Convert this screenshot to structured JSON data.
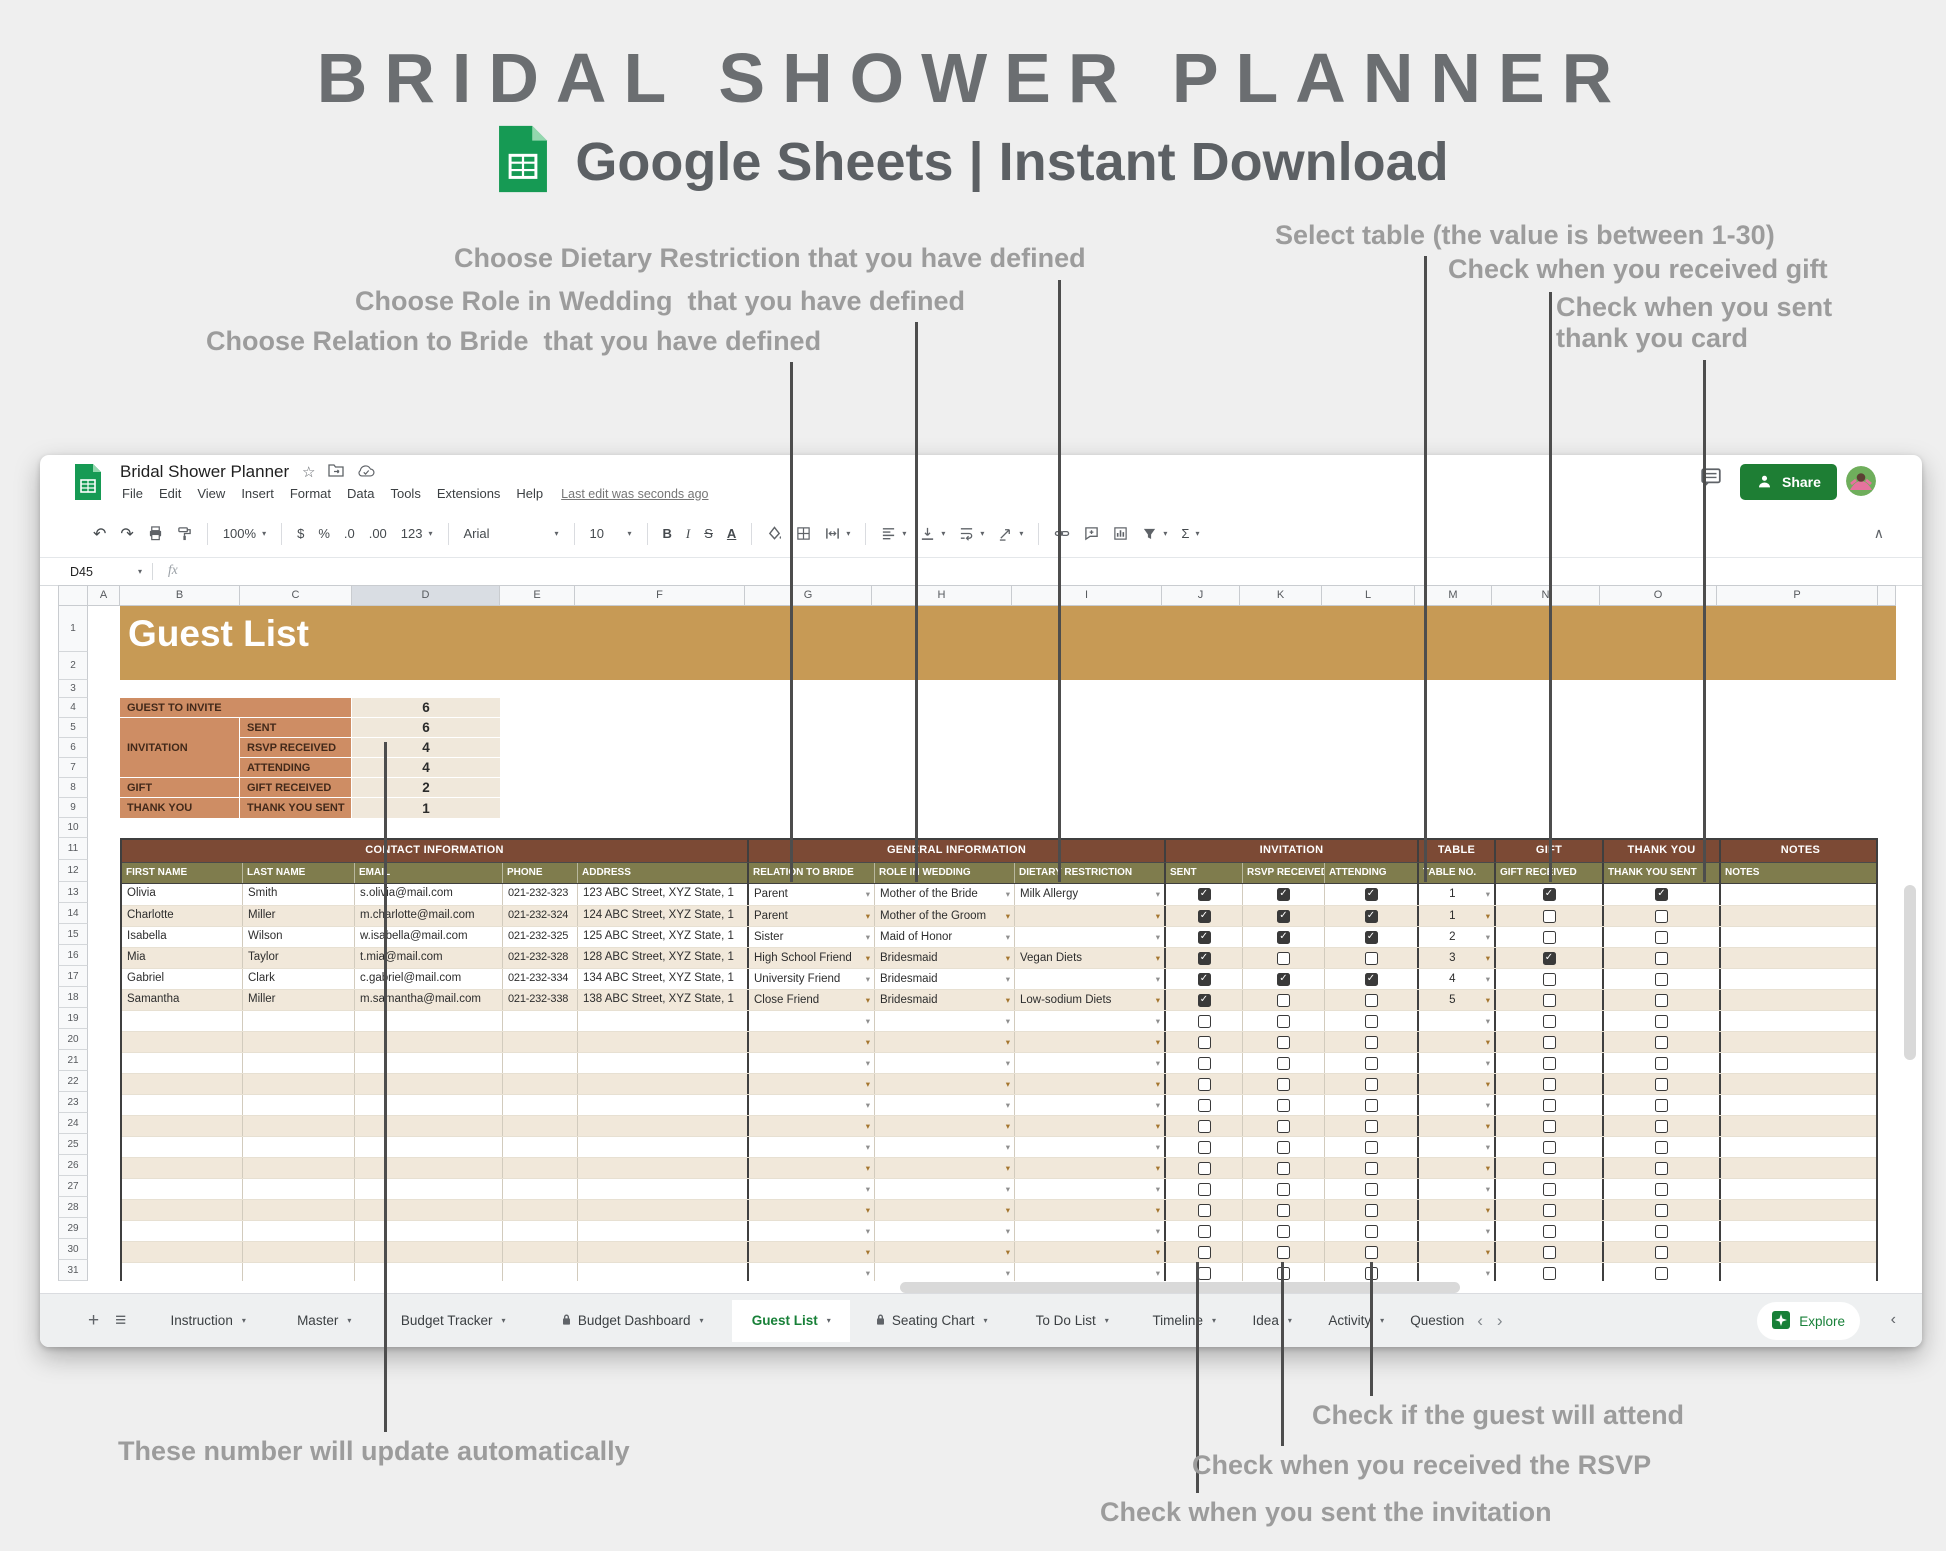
{
  "header": {
    "title": "BRIDAL SHOWER PLANNER",
    "subtitle": "Google Sheets | Instant Download"
  },
  "annotations": [
    {
      "id": "relation-to-bride",
      "text": "Choose Relation to Bride  that you have defined",
      "x": 206,
      "y": 326,
      "line": {
        "x": 790,
        "y1": 362,
        "y2": 882
      }
    },
    {
      "id": "role-in-wedding",
      "text": "Choose Role in Wedding  that you have defined",
      "x": 355,
      "y": 286,
      "line": {
        "x": 915,
        "y1": 322,
        "y2": 882
      }
    },
    {
      "id": "dietary-restriction",
      "text": "Choose Dietary Restriction that you have defined",
      "x": 454,
      "y": 243,
      "line": {
        "x": 1058,
        "y1": 280,
        "y2": 882
      }
    },
    {
      "id": "select-table",
      "text": "Select table (the value is between 1-30)",
      "x": 1275,
      "y": 220,
      "line": {
        "x": 1424,
        "y1": 256,
        "y2": 882
      }
    },
    {
      "id": "gift-received",
      "text": "Check when you received gift",
      "x": 1448,
      "y": 254,
      "line": {
        "x": 1549,
        "y1": 292,
        "y2": 882
      }
    },
    {
      "id": "thank-you-card",
      "text": "Check when you sent\nthank you card",
      "x": 1556,
      "y": 292,
      "line": {
        "x": 1703,
        "y1": 360,
        "y2": 882
      }
    },
    {
      "id": "auto-update",
      "text": "These number will update automatically",
      "x": 118,
      "y": 1436,
      "line": {
        "x": 384,
        "y1": 742,
        "y2": 1432
      }
    },
    {
      "id": "guest-attend",
      "text": "Check if the guest will attend",
      "x": 1312,
      "y": 1400,
      "line": {
        "x": 1370,
        "y1": 1262,
        "y2": 1396
      }
    },
    {
      "id": "rsvp-received",
      "text": "Check when you received the RSVP",
      "x": 1192,
      "y": 1450,
      "line": {
        "x": 1281,
        "y1": 1262,
        "y2": 1446
      }
    },
    {
      "id": "sent-invitation",
      "text": "Check when you sent the invitation",
      "x": 1100,
      "y": 1497,
      "line": {
        "x": 1196,
        "y1": 1262,
        "y2": 1493
      }
    }
  ],
  "window": {
    "doc_title": "Bridal Shower Planner",
    "menu": [
      "File",
      "Edit",
      "View",
      "Insert",
      "Format",
      "Data",
      "Tools",
      "Extensions",
      "Help"
    ],
    "last_edit": "Last edit was seconds ago",
    "share_label": "Share",
    "name_box": "D45",
    "fx": "fx",
    "toolbar": {
      "undo": "↶",
      "redo": "↷",
      "zoom": "100%",
      "currency": "$",
      "percent": "%",
      "dec_decrease": ".0",
      "dec_increase": ".00",
      "number_format": "123",
      "font": "Arial",
      "font_size": "10",
      "bold": "B",
      "italic": "I",
      "strikethrough": "S",
      "text_color": "A",
      "functions": "Σ",
      "collapse": "∧"
    }
  },
  "grid": {
    "columns": [
      "A",
      "B",
      "C",
      "D",
      "E",
      "F",
      "G",
      "H",
      "I",
      "J",
      "K",
      "L",
      "M",
      "N",
      "O",
      "P"
    ],
    "highlighted_column": "D",
    "row_count": 31,
    "banner_title": "Guest List"
  },
  "summary": {
    "rows": [
      {
        "category": "GUEST TO INVITE",
        "metric": "",
        "value": "6"
      },
      {
        "category": "INVITATION",
        "metric": "SENT",
        "value": "6"
      },
      {
        "category": "",
        "metric": "RSVP RECEIVED",
        "value": "4"
      },
      {
        "category": "",
        "metric": "ATTENDING",
        "value": "4"
      },
      {
        "category": "GIFT",
        "metric": "GIFT RECEIVED",
        "value": "2"
      },
      {
        "category": "THANK YOU",
        "metric": "THANK YOU SENT",
        "value": "1"
      }
    ]
  },
  "guest_table": {
    "groups": [
      {
        "label": "CONTACT INFORMATION",
        "span": 5
      },
      {
        "label": "GENERAL INFORMATION",
        "span": 3
      },
      {
        "label": "INVITATION",
        "span": 3
      },
      {
        "label": "TABLE",
        "span": 1
      },
      {
        "label": "GIFT",
        "span": 1
      },
      {
        "label": "THANK YOU",
        "span": 1
      },
      {
        "label": "NOTES",
        "span": 1
      }
    ],
    "headers": [
      "FIRST NAME",
      "LAST NAME",
      "EMAIL",
      "PHONE",
      "ADDRESS",
      "RELATION TO BRIDE",
      "ROLE IN WEDDING",
      "DIETARY RESTRICTION",
      "SENT",
      "RSVP RECEIVED",
      "ATTENDING",
      "TABLE NO.",
      "GIFT RECEIVED",
      "THANK YOU SENT",
      "NOTES"
    ],
    "rows": [
      {
        "first": "Olivia",
        "last": "Smith",
        "email": "s.olivia@mail.com",
        "phone": "021-232-323",
        "address": "123 ABC Street, XYZ State, 1",
        "relation": "Parent",
        "role": "Mother of the Bride",
        "dietary": "Milk Allergy",
        "sent": true,
        "rsvp_received": true,
        "attending": true,
        "table_no": "1",
        "gift_received": true,
        "thank_you_sent": true,
        "notes": ""
      },
      {
        "first": "Charlotte",
        "last": "Miller",
        "email": "m.charlotte@mail.com",
        "phone": "021-232-324",
        "address": "124 ABC Street, XYZ State, 1",
        "relation": "Parent",
        "role": "Mother of the Groom",
        "dietary": "",
        "sent": true,
        "rsvp_received": true,
        "attending": true,
        "table_no": "1",
        "gift_received": false,
        "thank_you_sent": false,
        "notes": ""
      },
      {
        "first": "Isabella",
        "last": "Wilson",
        "email": "w.isabella@mail.com",
        "phone": "021-232-325",
        "address": "125 ABC Street, XYZ State, 1",
        "relation": "Sister",
        "role": "Maid of Honor",
        "dietary": "",
        "sent": true,
        "rsvp_received": true,
        "attending": true,
        "table_no": "2",
        "gift_received": false,
        "thank_you_sent": false,
        "notes": ""
      },
      {
        "first": "Mia",
        "last": "Taylor",
        "email": "t.mia@mail.com",
        "phone": "021-232-328",
        "address": "128 ABC Street, XYZ State, 1",
        "relation": "High School Friend",
        "role": "Bridesmaid",
        "dietary": "Vegan Diets",
        "sent": true,
        "rsvp_received": false,
        "attending": false,
        "table_no": "3",
        "gift_received": true,
        "thank_you_sent": false,
        "notes": ""
      },
      {
        "first": "Gabriel",
        "last": "Clark",
        "email": "c.gabriel@mail.com",
        "phone": "021-232-334",
        "address": "134 ABC Street, XYZ State, 1",
        "relation": "University Friend",
        "role": "Bridesmaid",
        "dietary": "",
        "sent": true,
        "rsvp_received": true,
        "attending": true,
        "table_no": "4",
        "gift_received": false,
        "thank_you_sent": false,
        "notes": ""
      },
      {
        "first": "Samantha",
        "last": "Miller",
        "email": "m.samantha@mail.com",
        "phone": "021-232-338",
        "address": "138 ABC Street, XYZ State, 1",
        "relation": "Close Friend",
        "role": "Bridesmaid",
        "dietary": "Low-sodium Diets",
        "sent": true,
        "rsvp_received": false,
        "attending": false,
        "table_no": "5",
        "gift_received": false,
        "thank_you_sent": false,
        "notes": ""
      }
    ],
    "empty_rows": 13
  },
  "tabs": {
    "add_label": "+",
    "all_sheets_label": "≡",
    "items": [
      {
        "label": "Instruction"
      },
      {
        "label": "Master"
      },
      {
        "label": "Budget Tracker"
      },
      {
        "label": "Budget Dashboard",
        "locked": true
      },
      {
        "label": "Guest List",
        "active": true
      },
      {
        "label": "Seating Chart",
        "locked": true
      },
      {
        "label": "To Do List"
      },
      {
        "label": "Timeline"
      },
      {
        "label": "Idea"
      },
      {
        "label": "Activity"
      },
      {
        "label": "Question",
        "clipped": true
      }
    ],
    "explore_label": "Explore"
  },
  "colors": {
    "banner": "#C79A55",
    "summary_label": "#CE8D64",
    "summary_value": "#F0E8DB",
    "group_header": "#7C4A35",
    "column_header": "#7F7C4D",
    "row_alt": "#F1E8DA",
    "active_tab_green": "#188038",
    "share_green": "#1E7E34",
    "annotation_gray": "#9C9C9C"
  }
}
